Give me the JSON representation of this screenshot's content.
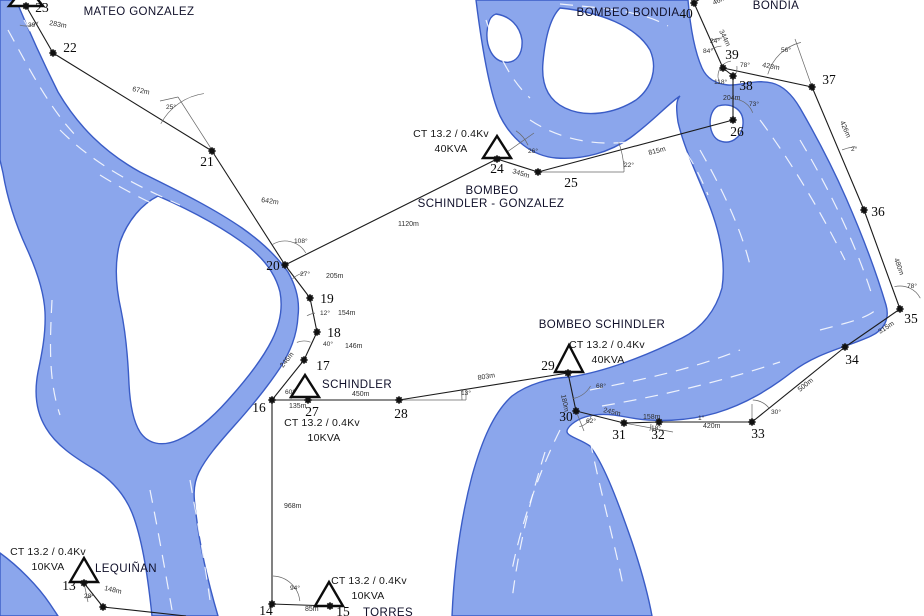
{
  "map": {
    "width": 924,
    "height": 616,
    "colors": {
      "background": "#ffffff",
      "river_fill": "#8ba6ec",
      "river_stroke": "#3a5cc6",
      "streak": "#ffffff",
      "line": "#1b1b1b",
      "guide": "#666666",
      "marker": "#111111"
    },
    "rivers": [
      "M0,0 L16,0 C26,24 40,56 58,92 C78,126 104,152 140,172 C172,188 210,206 242,228 C262,242 278,258 288,272 C296,286 300,300 298,316 C297,336 290,352 280,368 C268,386 252,406 234,426 C218,444 206,458 199,472 C192,486 194,500 196,514 C200,548 208,582 218,616 L152,616 C148,578 143,544 134,518 C126,495 112,480 94,469 C74,457 56,445 46,428 C36,412 34,393 38,372 C42,353 46,333 45,312 C44,292 37,271 27,249 C15,223 7,197 3,173 L0,160 Z M158,196 C190,210 224,228 250,248 C266,261 276,276 280,292 C283,308 280,324 272,340 C262,360 246,380 228,400 C212,418 196,432 178,440 C162,447 148,444 140,432 C133,421 130,404 129,384 C128,360 126,334 121,310 C116,288 114,264 120,242 C128,220 142,204 158,196 Z",
      "M0,553 C18,566 38,586 50,604 L58,616 L0,616 Z",
      "M476,0 L688,0 C690,24 694,50 702,68 C707,79 717,84 728,85 C740,86 756,79 772,83 C784,86 793,96 800,108 C815,134 832,166 846,198 C860,230 875,268 886,305 C890,319 884,330 871,336 C848,347 818,352 792,372 C770,389 746,404 716,413 C688,421 656,423 626,417 C602,412 584,414 572,424 C558,436 576,436 590,446 C602,462 614,490 632,542 C642,572 648,594 652,616 L452,616 C454,570 460,522 472,476 C482,440 494,412 512,396 C528,384 550,378 570,377 C604,372 646,356 682,338 C702,328 716,310 722,288 C726,262 720,232 708,202 C696,172 684,148 678,122 C676,108 676,100 680,96 C668,104 652,122 630,138 C610,152 584,160 556,158 C532,156 512,140 500,116 C490,94 482,48 476,0 Z M560,8 C600,12 636,26 650,50 C658,68 652,88 636,100 C614,114 586,118 565,108 C548,100 541,84 543,62 C545,40 550,18 560,8 Z M496,14 C510,16 520,26 522,40 C523,54 516,64 504,62 C492,60 486,46 487,32 C488,22 490,16 496,14 Z M718,106 C732,102 744,110 743,124 C742,138 730,146 718,140 C708,134 707,112 718,106 Z"
    ],
    "streaks": [
      "M8,30 C30,70 50,110 80,140",
      "M24,20 C46,60 70,105 104,142",
      "M60,130 C95,165 135,185 180,205",
      "M100,175 C140,200 180,216 222,236",
      "M52,300 C50,340 48,380 60,415",
      "M150,490 C158,530 165,570 172,610",
      "M190,480 C198,525 205,565 210,600",
      "M486,20 C496,50 510,80 530,98",
      "M560,4 C600,8 640,10 668,26",
      "M530,120 C560,140 600,148 640,140",
      "M660,118 C680,140 696,165 708,195",
      "M700,150 C720,185 740,225 750,265",
      "M760,120 C790,160 820,210 845,260",
      "M800,140 C830,190 856,245 872,295",
      "M590,390 C640,380 690,370 740,350",
      "M602,406 C660,396 720,382 780,362",
      "M820,330 C850,322 868,318 878,308",
      "M560,430 C540,470 522,520 512,570",
      "M590,440 C600,490 614,540 624,590",
      "M545,452 C530,500 518,550 512,600"
    ]
  },
  "stations": [
    {
      "label": "MATEO GONZALEZ",
      "x": 139,
      "y": 15,
      "anchor": "middle"
    },
    {
      "label": "BOMBEO BONDIA",
      "x": 628,
      "y": 16,
      "anchor": "middle"
    },
    {
      "label": "BONDIA",
      "x": 776,
      "y": 9,
      "anchor": "middle"
    },
    {
      "label": "BOMBEO",
      "x": 492,
      "y": 194,
      "anchor": "middle"
    },
    {
      "label": "SCHINDLER - GONZALEZ",
      "x": 491,
      "y": 207,
      "anchor": "middle"
    },
    {
      "label": "BOMBEO SCHINDLER",
      "x": 602,
      "y": 328,
      "anchor": "middle"
    },
    {
      "label": "SCHINDLER",
      "x": 322,
      "y": 388,
      "anchor": "start"
    },
    {
      "label": "LEQUIÑAN",
      "x": 126,
      "y": 572,
      "anchor": "middle"
    },
    {
      "label": "TORRES",
      "x": 388,
      "y": 616,
      "anchor": "middle"
    }
  ],
  "ct_labels": [
    {
      "line1": "CT 13.2 / 0.4Kv",
      "line2": "40KVA",
      "x1": 451,
      "y1": 137,
      "x2": 451,
      "y2": 152
    },
    {
      "line1": "CT 13.2 / 0.4Kv",
      "line2": "10KVA",
      "x1": 322,
      "y1": 426,
      "x2": 324,
      "y2": 441
    },
    {
      "line1": "CT 13.2 / 0.4Kv",
      "line2": "40KVA",
      "x1": 607,
      "y1": 348,
      "x2": 608,
      "y2": 363
    },
    {
      "line1": "CT 13.2 / 0.4Kv",
      "line2": "10KVA",
      "x1": 48,
      "y1": 555,
      "x2": 48,
      "y2": 570
    },
    {
      "line1": "CT 13.2 / 0.4Kv",
      "line2": "10KVA",
      "x1": 369,
      "y1": 584,
      "x2": 368,
      "y2": 599
    }
  ],
  "transformers": [
    {
      "id": "t23",
      "points": "26,-15 9,6 43,6"
    },
    {
      "id": "t24",
      "points": "497,136 483,158 511,158"
    },
    {
      "id": "t27",
      "points": "305,375 291,397 319,397"
    },
    {
      "id": "t29",
      "points": "569,345 555,372 583,372"
    },
    {
      "id": "t13",
      "points": "84,558 70,582 98,582"
    },
    {
      "id": "t15",
      "points": "329,582 315,606 343,606"
    }
  ],
  "nodes": [
    {
      "id": "13",
      "mx": 84,
      "my": 583,
      "label": "13",
      "lx": 69,
      "ly": 590
    },
    {
      "id": "14",
      "mx": 272,
      "my": 604,
      "label": "14",
      "lx": 266,
      "ly": 615
    },
    {
      "id": "15",
      "mx": 330,
      "my": 606,
      "label": "15",
      "lx": 343,
      "ly": 616
    },
    {
      "id": "16",
      "mx": 272,
      "my": 400,
      "label": "16",
      "lx": 259,
      "ly": 412
    },
    {
      "id": "17",
      "mx": 304,
      "my": 360,
      "label": "17",
      "lx": 323,
      "ly": 370
    },
    {
      "id": "18",
      "mx": 317,
      "my": 332,
      "label": "18",
      "lx": 334,
      "ly": 337
    },
    {
      "id": "19",
      "mx": 310,
      "my": 298,
      "label": "19",
      "lx": 327,
      "ly": 303
    },
    {
      "id": "20",
      "mx": 285,
      "my": 265,
      "label": "20",
      "lx": 273,
      "ly": 270
    },
    {
      "id": "21",
      "mx": 212,
      "my": 151,
      "label": "21",
      "lx": 207,
      "ly": 166
    },
    {
      "id": "22",
      "mx": 53,
      "my": 53,
      "label": "22",
      "lx": 70,
      "ly": 52
    },
    {
      "id": "23",
      "mx": 26,
      "my": 6,
      "label": "23",
      "lx": 42,
      "ly": 12
    },
    {
      "id": "24",
      "mx": 497,
      "my": 159,
      "label": "24",
      "lx": 497,
      "ly": 173
    },
    {
      "id": "25",
      "mx": 538,
      "my": 172,
      "label": "25",
      "lx": 571,
      "ly": 187
    },
    {
      "id": "26",
      "mx": 733,
      "my": 120,
      "label": "26",
      "lx": 737,
      "ly": 136
    },
    {
      "id": "27",
      "mx": 308,
      "my": 400,
      "label": "27",
      "lx": 312,
      "ly": 416
    },
    {
      "id": "28",
      "mx": 399,
      "my": 400,
      "label": "28",
      "lx": 401,
      "ly": 418
    },
    {
      "id": "29",
      "mx": 568,
      "my": 373,
      "label": "29",
      "lx": 548,
      "ly": 370
    },
    {
      "id": "30",
      "mx": 576,
      "my": 411,
      "label": "30",
      "lx": 566,
      "ly": 421
    },
    {
      "id": "31",
      "mx": 624,
      "my": 423,
      "label": "31",
      "lx": 619,
      "ly": 439
    },
    {
      "id": "32",
      "mx": 659,
      "my": 422,
      "label": "32",
      "lx": 658,
      "ly": 439
    },
    {
      "id": "33",
      "mx": 752,
      "my": 422,
      "label": "33",
      "lx": 758,
      "ly": 438
    },
    {
      "id": "34",
      "mx": 845,
      "my": 347,
      "label": "34",
      "lx": 852,
      "ly": 364
    },
    {
      "id": "35",
      "mx": 900,
      "my": 309,
      "label": "35",
      "lx": 911,
      "ly": 323
    },
    {
      "id": "36",
      "mx": 864,
      "my": 210,
      "label": "36",
      "lx": 878,
      "ly": 216
    },
    {
      "id": "37",
      "mx": 812,
      "my": 87,
      "label": "37",
      "lx": 829,
      "ly": 84
    },
    {
      "id": "38",
      "mx": 733,
      "my": 76,
      "label": "38",
      "lx": 746,
      "ly": 90
    },
    {
      "id": "39",
      "mx": 723,
      "my": 68,
      "label": "39",
      "lx": 732,
      "ly": 59
    },
    {
      "id": "40",
      "mx": 694,
      "my": 3,
      "label": "40",
      "lx": 686,
      "ly": 18
    },
    {
      "id": "n1",
      "mx": 103,
      "my": 607,
      "label": "",
      "lx": 0,
      "ly": 0
    }
  ],
  "edges": [
    {
      "name": "23-22",
      "p1": "23",
      "p2": "22",
      "label": "283m",
      "lx": 49,
      "ly": 25,
      "rot": 10
    },
    {
      "name": "22-21",
      "p1": "22",
      "p2": "21",
      "label": "672m",
      "lx": 132,
      "ly": 91,
      "rot": 12
    },
    {
      "name": "21-20",
      "p1": "21",
      "p2": "20",
      "label": "642m",
      "lx": 261,
      "ly": 202,
      "rot": 8
    },
    {
      "name": "20-24",
      "p1": "20",
      "p2": "24",
      "label": "1120m",
      "lx": 398,
      "ly": 226,
      "rot": 0
    },
    {
      "name": "24-25",
      "p1": "24",
      "p2": "25",
      "label": "345m",
      "lx": 512,
      "ly": 173,
      "rot": 17
    },
    {
      "name": "25-26",
      "p1": "25",
      "p2": "26",
      "label": "815m",
      "lx": 649,
      "ly": 155,
      "rot": -14
    },
    {
      "name": "26-38",
      "p1": "26",
      "p2": "38",
      "label": "204m",
      "lx": 723,
      "ly": 100,
      "rot": 0
    },
    {
      "name": "38-39",
      "p1": "38",
      "p2": "39",
      "label": "",
      "lx": 0,
      "ly": 0,
      "rot": 0
    },
    {
      "name": "39-40",
      "p1": "39",
      "p2": "40",
      "label": "344m",
      "lx": 719,
      "ly": 31,
      "rot": 64
    },
    {
      "name": "40-stub",
      "p1": "40",
      "p2": [
        707,
        -6
      ],
      "label": "46m",
      "lx": 714,
      "ly": 5,
      "rot": -25
    },
    {
      "name": "39-37",
      "p1": "39",
      "p2": "37",
      "label": "428m",
      "lx": 762,
      "ly": 67,
      "rot": 10
    },
    {
      "name": "37-36",
      "p1": "37",
      "p2": "36",
      "label": "426m",
      "lx": 840,
      "ly": 122,
      "rot": 67
    },
    {
      "name": "36-35",
      "p1": "36",
      "p2": "35",
      "label": "480m",
      "lx": 894,
      "ly": 259,
      "rot": 70
    },
    {
      "name": "35-34",
      "p1": "35",
      "p2": "34",
      "label": "315m",
      "lx": 880,
      "ly": 334,
      "rot": -33
    },
    {
      "name": "34-33",
      "p1": "34",
      "p2": "33",
      "label": "500m",
      "lx": 800,
      "ly": 392,
      "rot": -39
    },
    {
      "name": "33-32",
      "p1": "33",
      "p2": "32",
      "label": "420m",
      "lx": 703,
      "ly": 428,
      "rot": 0
    },
    {
      "name": "32-31",
      "p1": "32",
      "p2": "31",
      "label": "158m",
      "lx": 643,
      "ly": 419,
      "rot": 0
    },
    {
      "name": "31-30",
      "p1": "31",
      "p2": "30",
      "label": "245m",
      "lx": 603,
      "ly": 412,
      "rot": 13
    },
    {
      "name": "30-29",
      "p1": "30",
      "p2": "29",
      "label": "180m",
      "lx": 561,
      "ly": 395,
      "rot": 78
    },
    {
      "name": "29-28",
      "p1": "29",
      "p2": "28",
      "label": "803m",
      "lx": 478,
      "ly": 380,
      "rot": -9
    },
    {
      "name": "28-27",
      "p1": "28",
      "p2": "27",
      "label": "450m",
      "lx": 352,
      "ly": 396,
      "rot": 0
    },
    {
      "name": "27-16",
      "p1": "27",
      "p2": "16",
      "label": "135m",
      "lx": 289,
      "ly": 408,
      "rot": 0
    },
    {
      "name": "16-17",
      "p1": "16",
      "p2": "17",
      "label": "246m",
      "lx": 283,
      "ly": 368,
      "rot": -51
    },
    {
      "name": "17-18",
      "p1": "17",
      "p2": "18",
      "label": "146m",
      "lx": 345,
      "ly": 348,
      "rot": 0
    },
    {
      "name": "18-19",
      "p1": "18",
      "p2": "19",
      "label": "154m",
      "lx": 338,
      "ly": 315,
      "rot": 0
    },
    {
      "name": "19-20",
      "p1": "19",
      "p2": "20",
      "label": "205m",
      "lx": 326,
      "ly": 278,
      "rot": 0
    },
    {
      "name": "16-14",
      "p1": "16",
      "p2": "14",
      "label": "968m",
      "lx": 284,
      "ly": 508,
      "rot": 0
    },
    {
      "name": "14-15",
      "p1": "14",
      "p2": "15",
      "label": "85m",
      "lx": 305,
      "ly": 611,
      "rot": 0
    },
    {
      "name": "13-n1",
      "p1": "13",
      "p2": "n1",
      "label": "148m",
      "lx": 104,
      "ly": 590,
      "rot": 13
    },
    {
      "name": "n1-exit",
      "p1": "n1",
      "p2": [
        186,
        616
      ],
      "label": "",
      "lx": 0,
      "ly": 0,
      "rot": 0
    }
  ],
  "angles": [
    {
      "text": "39°",
      "x": 28,
      "y": 27,
      "arc": [
        26,
        6,
        20,
        52,
        108
      ]
    },
    {
      "text": "25°",
      "x": 166,
      "y": 109,
      "arc": [
        212,
        151,
        58,
        208,
        262
      ]
    },
    {
      "text": "108°",
      "x": 294,
      "y": 243,
      "arc": [
        285,
        265,
        24,
        237,
        330
      ]
    },
    {
      "text": "27°",
      "x": 300,
      "y": 276,
      "arc": [
        310,
        298,
        26,
        228,
        258
      ]
    },
    {
      "text": "12°",
      "x": 320,
      "y": 315,
      "arc": [
        317,
        332,
        19,
        238,
        264
      ]
    },
    {
      "text": "40°",
      "x": 323,
      "y": 346,
      "arc": [
        304,
        360,
        19,
        248,
        290
      ]
    },
    {
      "text": "60°",
      "x": 285,
      "y": 394,
      "arc": [
        308,
        400,
        17,
        183,
        243
      ]
    },
    {
      "text": "13°",
      "x": 461,
      "y": 395,
      "arc": [
        399,
        400,
        63,
        350,
        360
      ]
    },
    {
      "text": "68°",
      "x": 596,
      "y": 388,
      "arc": [
        568,
        373,
        26,
        30,
        80
      ]
    },
    {
      "text": "62°",
      "x": 586,
      "y": 423,
      "arc": [
        576,
        411,
        16,
        16,
        78
      ]
    },
    {
      "text": "18°",
      "x": 651,
      "y": 430,
      "arc": [
        624,
        423,
        27,
        2,
        17
      ]
    },
    {
      "text": "1°",
      "x": 698,
      "y": 420,
      "arc": null
    },
    {
      "text": "30°",
      "x": 771,
      "y": 414,
      "arc": [
        752,
        422,
        22,
        272,
        320
      ]
    },
    {
      "text": "78°",
      "x": 907,
      "y": 288,
      "arc": [
        900,
        309,
        23,
        256,
        332
      ]
    },
    {
      "text": "2°",
      "x": 851,
      "y": 151,
      "arc": [
        864,
        210,
        64,
        250,
        262
      ]
    },
    {
      "text": "56°",
      "x": 781,
      "y": 52,
      "arc": [
        812,
        87,
        46,
        196,
        256
      ]
    },
    {
      "text": "78°",
      "x": 740,
      "y": 67,
      "arc": [
        723,
        68,
        14,
        352,
        34
      ]
    },
    {
      "text": "118°",
      "x": 714,
      "y": 84,
      "arc": [
        733,
        76,
        15,
        150,
        262
      ]
    },
    {
      "text": "73°",
      "x": 749,
      "y": 106,
      "arc": [
        733,
        120,
        21,
        274,
        340
      ]
    },
    {
      "text": "26°",
      "x": 528,
      "y": 153,
      "arc": [
        497,
        159,
        34,
        304,
        336
      ]
    },
    {
      "text": "22°",
      "x": 624,
      "y": 167,
      "arc": [
        538,
        172,
        86,
        340,
        358
      ]
    },
    {
      "text": "24°",
      "x": 710,
      "y": 43,
      "arc": [
        723,
        68,
        30,
        246,
        268
      ]
    },
    {
      "text": "84°",
      "x": 703,
      "y": 53,
      "arc": [
        723,
        68,
        22,
        238,
        266
      ]
    },
    {
      "text": "94°",
      "x": 290,
      "y": 590,
      "arc": [
        272,
        604,
        28,
        272,
        354
      ]
    },
    {
      "text": "28°",
      "x": 84,
      "y": 598,
      "arc": [
        84,
        583,
        15,
        55,
        85
      ]
    }
  ],
  "guides": [
    [
      160,
      101,
      178,
      97
    ],
    [
      178,
      97,
      212,
      150
    ],
    [
      538,
      172,
      624,
      172
    ],
    [
      624,
      172,
      624,
      161
    ],
    [
      399,
      400,
      466,
      400
    ],
    [
      466,
      400,
      466,
      390
    ],
    [
      795,
      39,
      812,
      87
    ],
    [
      497,
      159,
      534,
      133
    ],
    [
      84,
      583,
      88,
      602
    ],
    [
      624,
      423,
      673,
      432
    ],
    [
      752,
      422,
      752,
      404
    ],
    [
      576,
      411,
      584,
      431
    ]
  ]
}
